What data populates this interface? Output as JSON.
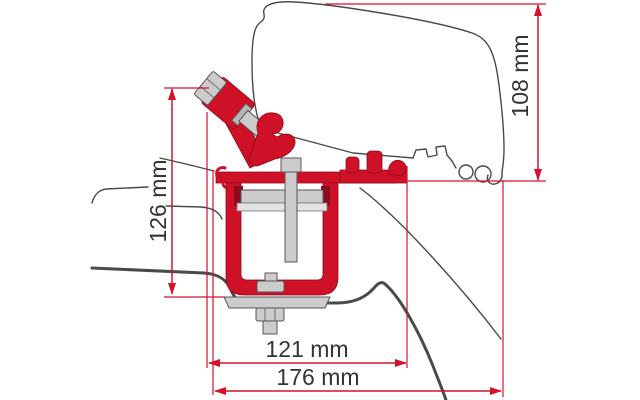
{
  "diagram": {
    "title": "Awning adapter bracket on van roof - technical cross-section drawing",
    "type": "technical-dimension-drawing",
    "unit": "mm",
    "dimensions": [
      {
        "name": "roof-top-to-gutter-height",
        "label": "108 mm",
        "value": 108,
        "orientation": "vertical"
      },
      {
        "name": "bracket-overall-height",
        "label": "126 mm",
        "value": 126,
        "orientation": "vertical"
      },
      {
        "name": "bracket-width",
        "label": "121 mm",
        "value": 121,
        "orientation": "horizontal"
      },
      {
        "name": "overall-width",
        "label": "176 mm",
        "value": 176,
        "orientation": "horizontal"
      }
    ],
    "colors": {
      "dimension_red": "#d6112b",
      "bracket_red": "#ce1126",
      "bracket_red_dark": "#8f0a1c",
      "hardware_gray": "#cccccc",
      "outline_gray": "#4a4a4a",
      "label_text": "#333333",
      "background": "#ffffff"
    }
  }
}
